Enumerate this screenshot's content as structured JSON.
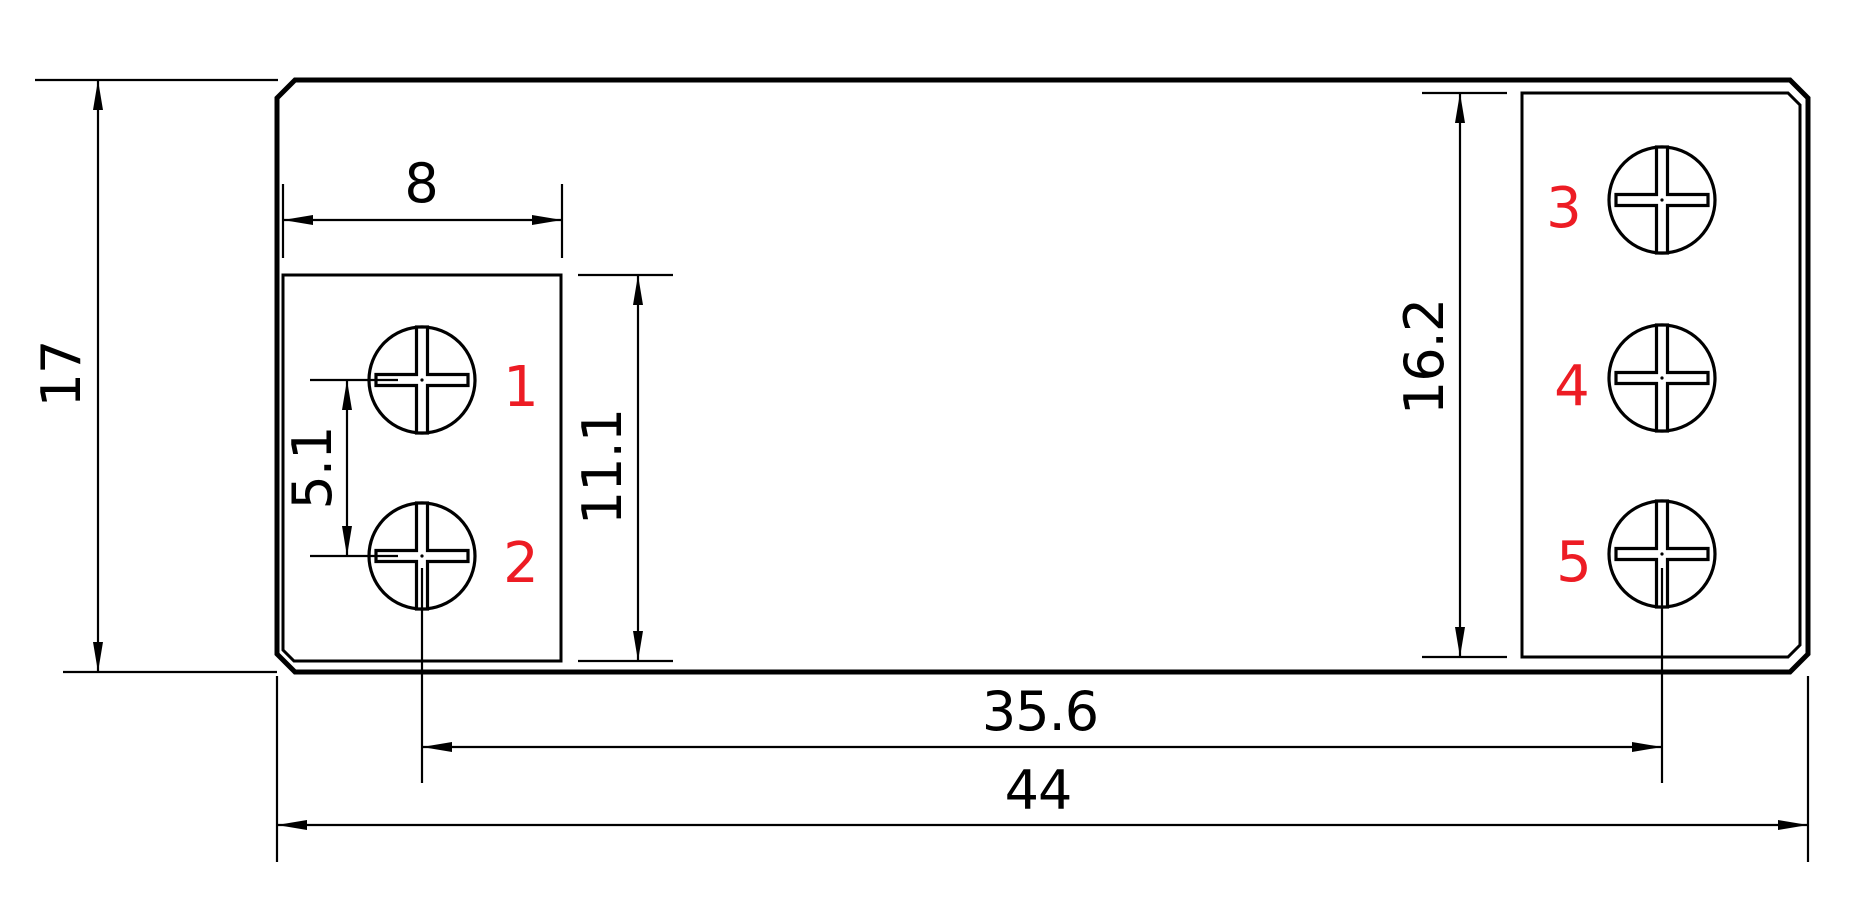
{
  "drawing": {
    "colors": {
      "ink": "#000000",
      "red": "#ED1C24",
      "bg": "#ffffff"
    },
    "dimensions": {
      "overall_height": "17",
      "left_block_width": "8",
      "terminal_pitch": "5.1",
      "left_block_height": "11.1",
      "right_block_height": "16.2",
      "terminal_span": "35.6",
      "overall_width": "44"
    },
    "terminal_labels": [
      "1",
      "2",
      "3",
      "4",
      "5"
    ]
  }
}
